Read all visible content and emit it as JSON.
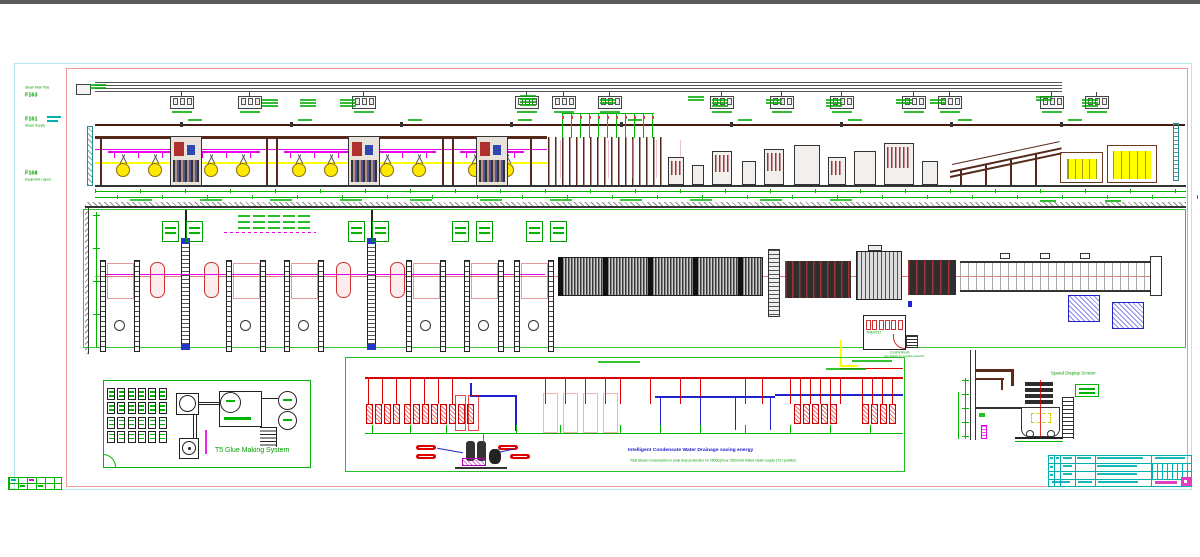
{
  "sheet": {
    "type": "CAD production line layout drawing"
  },
  "colors": {
    "frame_cyan": "#b5e8e8",
    "frame_red": "#f29a9a",
    "cad_green": "#00a000",
    "magenta": "#e800e8",
    "maroon": "#56281a",
    "roll_yellow": "#ffe900",
    "stack_yellow": "#ffff00",
    "pipe_red": "#dd0000",
    "pipe_blue": "#2222cc",
    "titleblock_cyan": "#00b0b0",
    "logo_magenta": "#e040c0"
  },
  "elevation": {
    "labels": [
      {
        "code": "F163",
        "desc": "Steam Main Pipe"
      },
      {
        "code": "F161",
        "desc": "Steam Supply"
      },
      {
        "code": "F168",
        "desc": "Equipment Layout"
      }
    ]
  },
  "plan": {
    "control_room": {
      "code": "TRE0912",
      "caption1": "Control Room",
      "caption2": "Key Switch for Condition Electric"
    }
  },
  "glue_system": {
    "title": "T5 Glue Making System"
  },
  "steam": {
    "title": "Intelligent Condensate Water Drainage saving energy",
    "subtitle": "Total Steam Consumption in peak duty production for 2500kg/hour 250m/min Rated steam supply (T3 I position)"
  },
  "speed_display": {
    "label": "Speed Display Screen"
  }
}
